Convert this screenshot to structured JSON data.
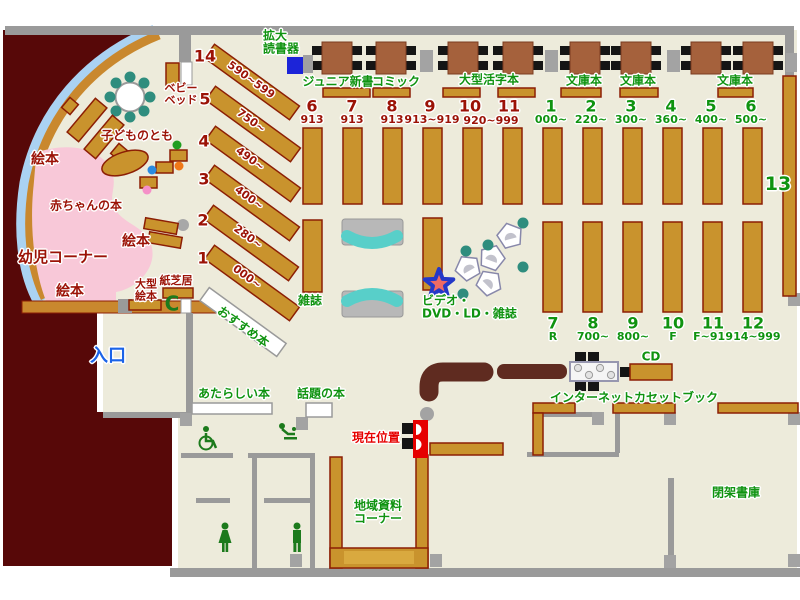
{
  "labels": {
    "magnifier": "拡大\n読書器",
    "junior_shinsho": "ジュニア新書",
    "comic": "コミック",
    "large_print": "大型活字本",
    "bunko_1": "文庫本",
    "bunko_2": "文庫本",
    "bunko_3": "文庫本",
    "shelf13": "13",
    "zasshi": "雑誌",
    "video": "ビデオ・\nDVD・LD・雑誌",
    "cd": "CD",
    "internet": "インターネット",
    "cassette_book": "カセットブック",
    "osusume": "おすすめ本",
    "atarashii": "あたらしい本",
    "wadai": "話題の本",
    "chiiki": "地域資料\nコーナー",
    "heika": "閉架書庫",
    "baby_bed": "ベビー\nベッド",
    "kodomo_no_tomo": "子どものとも",
    "ehon_1": "絵本",
    "ehon_2": "絵本",
    "ehon_3": "絵本",
    "akachan": "赤ちゃんの本",
    "yoji_corner": "幼児コーナー",
    "ogata_ehon": "大型\n絵本",
    "kamishibai": "紙芝居",
    "genzai_ichi": "現在位置",
    "iriguchi": "入口"
  },
  "nums": {
    "diag": [
      {
        "n": "14",
        "r": "590~599"
      },
      {
        "n": "5",
        "r": "750~"
      },
      {
        "n": "4",
        "r": "490~"
      },
      {
        "n": "3",
        "r": "400~"
      },
      {
        "n": "2",
        "r": "280~"
      },
      {
        "n": "1",
        "r": "000~"
      }
    ],
    "red_row": [
      {
        "n": "6",
        "r": "913"
      },
      {
        "n": "7",
        "r": "913"
      },
      {
        "n": "8",
        "r": "913"
      },
      {
        "n": "9",
        "r": "913~919"
      },
      {
        "n": "10",
        "r": ""
      },
      {
        "n": "11",
        "r": ""
      }
    ],
    "red_shared": "920~999",
    "green_top": [
      {
        "n": "1",
        "r": "000~"
      },
      {
        "n": "2",
        "r": "220~"
      },
      {
        "n": "3",
        "r": "300~"
      },
      {
        "n": "4",
        "r": "360~"
      },
      {
        "n": "5",
        "r": "400~"
      },
      {
        "n": "6",
        "r": "500~"
      }
    ],
    "green_bottom": [
      {
        "n": "7",
        "r": "R"
      },
      {
        "n": "8",
        "r": "700~"
      },
      {
        "n": "9",
        "r": "800~"
      },
      {
        "n": "10",
        "r": "F"
      },
      {
        "n": "11",
        "r": "F~914"
      },
      {
        "n": "12",
        "r": "914~999"
      }
    ]
  },
  "icons": {
    "phone": "C"
  },
  "colors": {
    "floor": "#edebdb",
    "outside": "#570808",
    "shelf": "#c9932d",
    "shelf_border": "#8c1e04",
    "wall": "#9a9a9a",
    "pink_area": "#f8c8d8",
    "window": "#aad2f2",
    "bench_teal": "#58cfc9",
    "green_text": "#0f9310",
    "darkred_text": "#9b1206",
    "red_marker": "#e60000",
    "blue_text": "#1b63e8",
    "machine_blue": "#1c24d8",
    "counter": "#5f2b20",
    "table": "#a5613c"
  }
}
